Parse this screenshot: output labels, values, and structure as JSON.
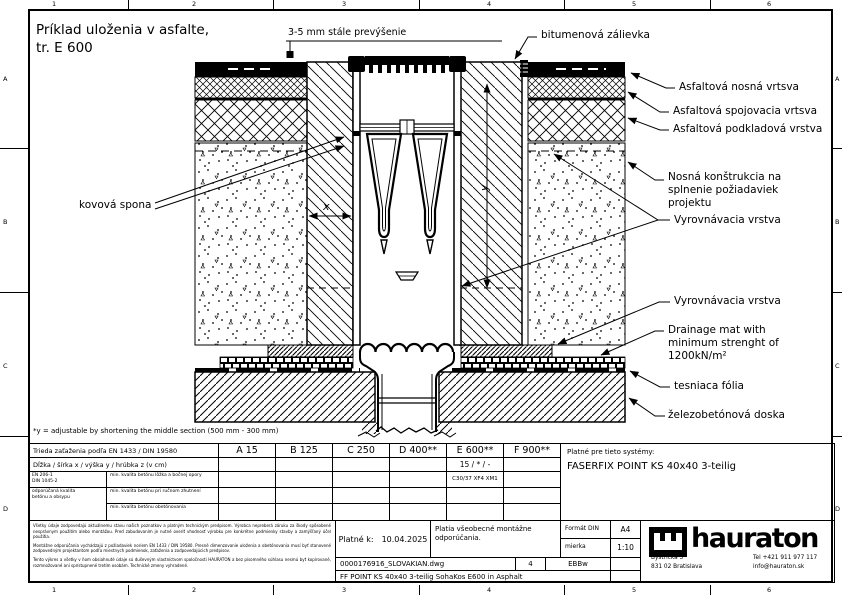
{
  "sheet": {
    "ruler_top": [
      "1",
      "2",
      "3",
      "4",
      "5",
      "6"
    ],
    "ruler_bottom": [
      "1",
      "2",
      "3",
      "4",
      "5",
      "6"
    ],
    "ruler_left": [
      "A",
      "B",
      "C",
      "D"
    ],
    "ruler_right": [
      "A",
      "B",
      "C",
      "D"
    ]
  },
  "drawing": {
    "title": "Príklad uloženia v asfalte,\ntr. E 600",
    "labels": {
      "surface_note": "3-5 mm stále prevýšenie",
      "bitumen_joint": "bitumenová zálievka",
      "asphalt_wearing": "Asfaltová nosná vrtsva",
      "asphalt_binder": "Asfaltová spojovacia vrtsva",
      "asphalt_base": "Asfaltová podkladová vrstva",
      "bearing_structure": "Nosná konštrukcia na\nsplnenie požiadaviek\nprojektu",
      "leveling_upper": "Vyrovnávacia vrstva",
      "leveling_lower": "Vyrovnávacia vrstva",
      "drainage_mat": "Drainage mat with\nminimum strenght of\n1200kN/m²",
      "sealing_foil": "tesniaca fólia",
      "concrete_slab": "železobetónová doska",
      "metal_clamp": "kovová spona",
      "dim_x": "x",
      "dim_y": "y"
    },
    "footnote": "*y = adjustable by shortening the middle section (500 mm - 300 mm)"
  },
  "load_table": {
    "row_class_label": "Trieda zaťaženia podľa EN 1433 / DIN 19580",
    "row_dims_label": "Dĺžka / šírka x / výška y / hrúbka z (v cm)",
    "classes": [
      "A 15",
      "B 125",
      "C 250",
      "D 400**",
      "E 600**",
      "F 900**"
    ],
    "dims_value_e600": "15 / * / -",
    "concrete_value_e600": "C30/37 XF4 XM1",
    "norm_ref": "EN 206-1\nDIN 1045-2",
    "norm_note": "odporúčaná kvalita\nbetónu a obsypu",
    "concrete_rows": [
      "min. kvalita betónu lôžka a bočnej opory",
      "min. kvalita betónu pri ručnom zhutnení",
      "min. kvalita betónu obetónovania"
    ],
    "systems_label": "Platné pre tieto systémy:",
    "systems_value": "FASERFIX POINT KS 40x40 3-teilig"
  },
  "title_block": {
    "disclaimer_1": "Všetky údaje zodpovedajú aktuálnemu stavu našich poznatkov a platným technickým predpisom. Výrobca nepreberá záruku za škody spôsobené nesprávnym použitím alebo montážou. Pred zabudovaním je nutné overiť vhodnosť výrobku pre konkrétne podmienky stavby a zamýšľaný účel použitia.",
    "disclaimer_2": "Montážne odporúčania vychádzajú z požiadaviek noriem EN 1433 / DIN 19580. Presné dimenzovanie uloženia a obetónovania musí byť stanovené zodpovedným projektantom podľa miestnych podmienok, zaťaženia a zodpovedajúcich predpisov.",
    "disclaimer_3": "Tento výkres a všetky v ňom obsiahnuté údaje sú duševným vlastníctvom spoločnosti HAURATON a bez písomného súhlasu nesmú byť kopírované, rozmnožované ani sprístupnené tretím osobám. Technické zmeny vyhradené.",
    "valid_label": "Platné k:",
    "valid_date": "10.04.2025",
    "general_note": "Platia všeobecné montážne odporúčania.",
    "format_label": "Formát DIN",
    "format_value": "A4",
    "scale_label": "mierka",
    "scale_value": "1:10",
    "drawing_file": "0000176916_SLOVAKIAN.dwg",
    "sheet_no": "4",
    "author_code": "EBBw",
    "drawing_name": "FF POINT KS 40x40 3-teilig SohaKos E600 in Asphalt",
    "brand": "hauraton",
    "address_lines": "Bystrická 3\n831 02 Bratislava",
    "contact_lines": "Tel +421 911 977 117\ninfo@hauraton.sk"
  }
}
